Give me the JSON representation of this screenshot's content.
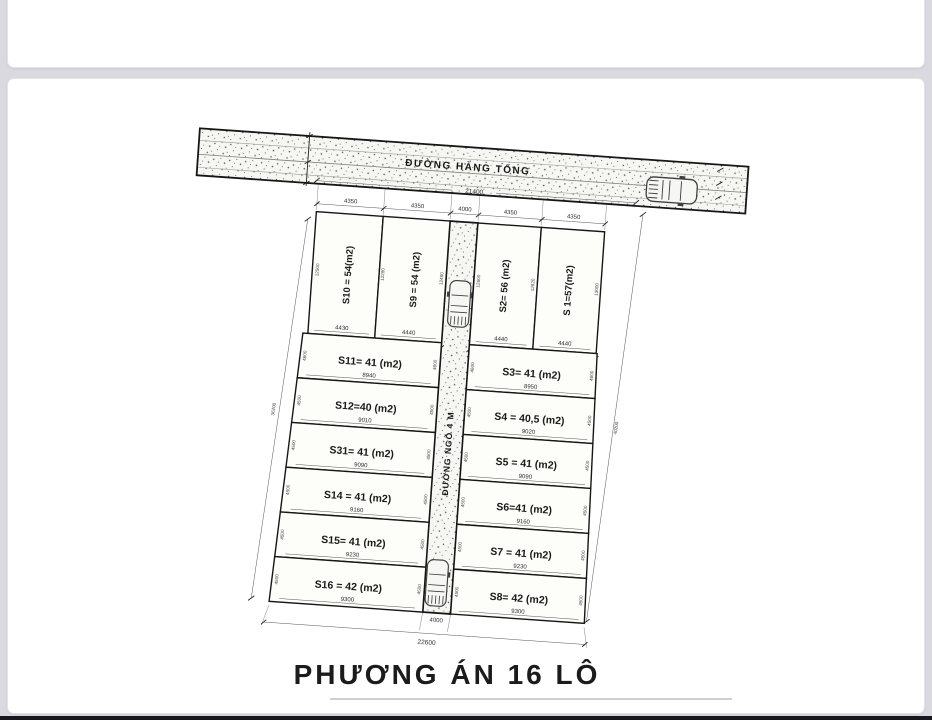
{
  "page": {
    "title": "PHƯƠNG ÁN  16 LÔ"
  },
  "main_road": {
    "name": "ĐƯỜNG HÀNG TỔNG",
    "length_dim": "21400"
  },
  "alley": {
    "name": "ĐƯỜNG NGÕ 4 M",
    "top_dim": "4000",
    "bottom_dim": "4000",
    "side_dim_left": "30700",
    "side_dim_right": "30700"
  },
  "frontage_dims": [
    "4350",
    "4350",
    "4000",
    "4350",
    "4350"
  ],
  "left_column": {
    "outer_dim": "36200",
    "subtotal_dim": "8870",
    "top_plots": [
      {
        "label": "S10 = 54(m2)",
        "front_dim": "4430",
        "depth_dim": "12500"
      },
      {
        "label": "S9 = 54 (m2)",
        "front_dim": "4440",
        "depth_left_dim": "12280",
        "depth_right_dim": "12460"
      }
    ],
    "plots": [
      {
        "label": "S11= 41 (m2)",
        "width_dim": "8940",
        "depth_dim": "4600"
      },
      {
        "label": "S12=40 (m2)",
        "width_dim": "9010",
        "depth_dim": "4500"
      },
      {
        "label": "S31= 41 (m2)",
        "width_dim": "9090",
        "depth_dim": "4500"
      },
      {
        "label": "S14 = 41 (m2)",
        "width_dim": "9160",
        "depth_dim": "4500"
      },
      {
        "label": "S15= 41 (m2)",
        "width_dim": "9230",
        "depth_dim": "4500"
      },
      {
        "label": "S16 = 42 (m2)",
        "width_dim": "9300",
        "depth_dim": "4500"
      }
    ]
  },
  "right_column": {
    "outer_dim": "40200",
    "subtotal_dim": "8880",
    "top_plots": [
      {
        "label": "S2= 56 (m2)",
        "front_dim": "4440",
        "depth_left_dim": "12600",
        "depth_right_dim": "12820"
      },
      {
        "label": "S 1=57(m2)",
        "front_dim": "4440",
        "depth_dim": "13000"
      }
    ],
    "plots": [
      {
        "label": "S3= 41 (m2)",
        "width_dim": "8950",
        "depth_dim": "4600"
      },
      {
        "label": "S4 = 40,5 (m2)",
        "width_dim": "9020",
        "depth_dim": "4500"
      },
      {
        "label": "S5 = 41 (m2)",
        "width_dim": "9090",
        "depth_dim": "4500"
      },
      {
        "label": "S6=41 (m2)",
        "width_dim": "9160",
        "depth_dim": "4500"
      },
      {
        "label": "S7 = 41 (m2)",
        "width_dim": "9230",
        "depth_dim": "4500"
      },
      {
        "label": "S8= 42 (m2)",
        "width_dim": "9300",
        "depth_dim": "4500"
      }
    ]
  },
  "bottom_total_dim": "22600"
}
